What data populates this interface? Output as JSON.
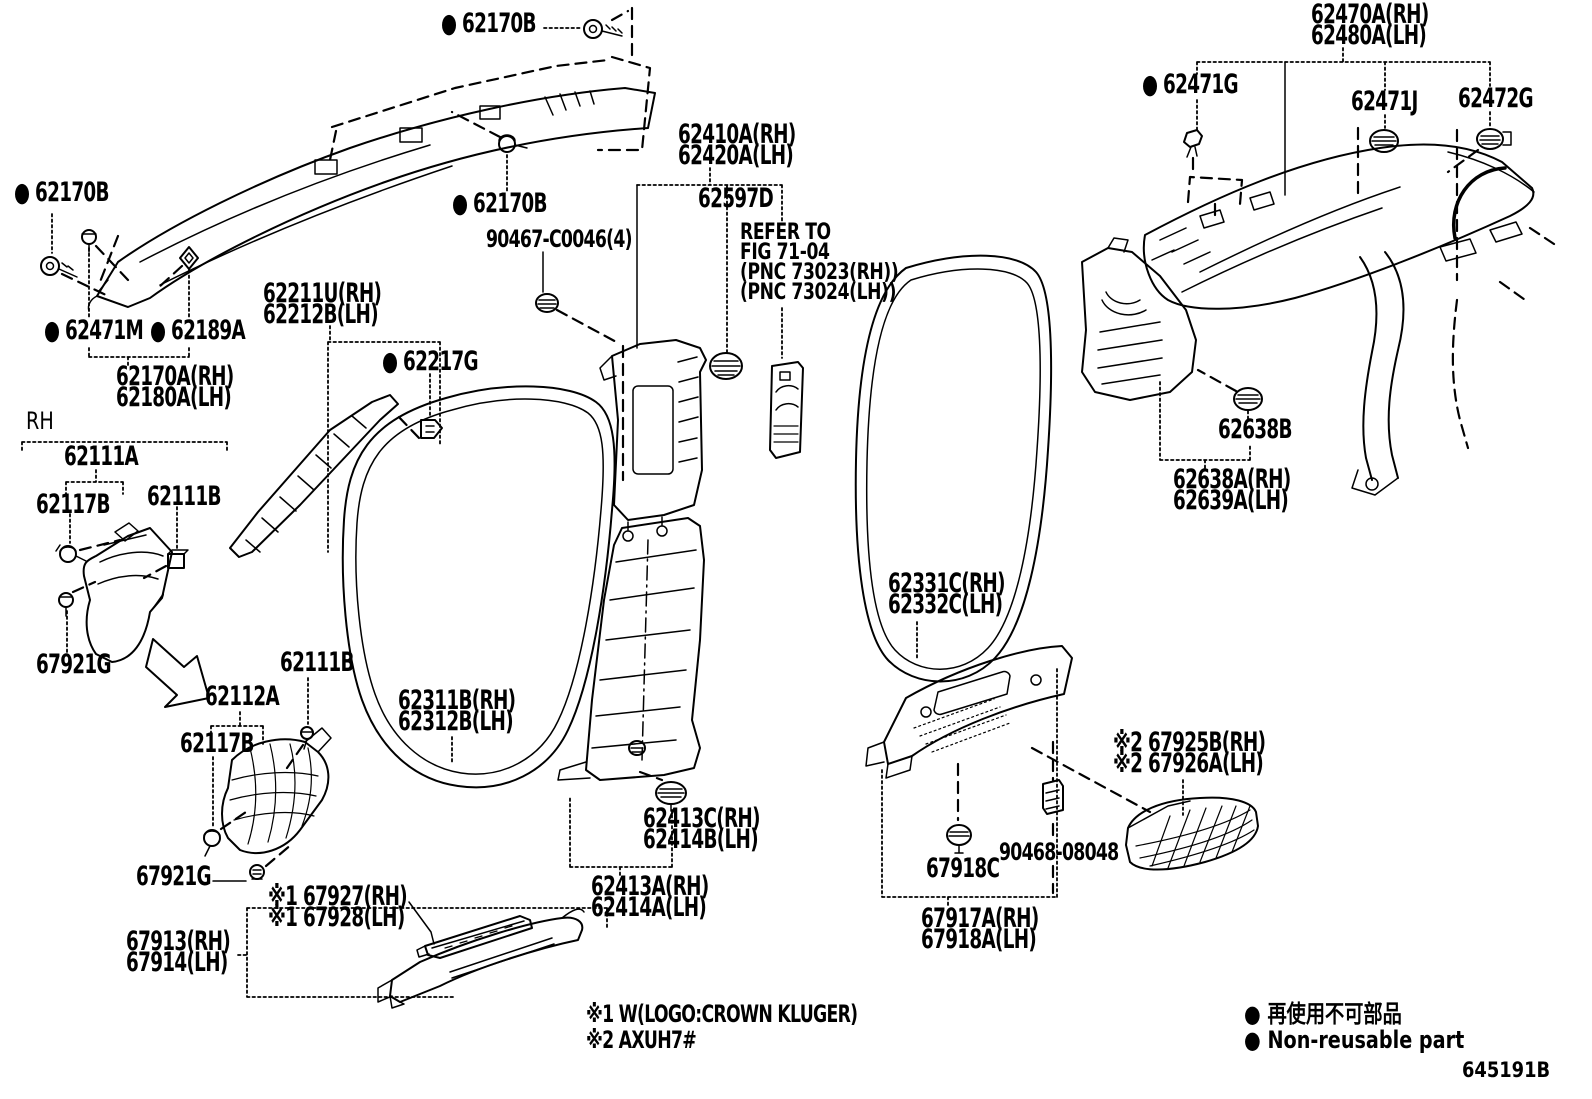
{
  "figure": {
    "code": "645191B"
  },
  "legend": {
    "jp": "● 再使用不可部品",
    "en": "● Non-reusable part"
  },
  "notes": {
    "note1": "※1 W(LOGO:CROWN KLUGER)",
    "note2": "※2 AXUH7#"
  },
  "section_marker": {
    "rh": "RH"
  },
  "labels": {
    "l62170b_top": {
      "text": "● 62170B"
    },
    "l62170b_left": {
      "text": "● 62170B"
    },
    "l62170b_mid": {
      "text": "● 62170B"
    },
    "l62471m": {
      "text": "● 62471M"
    },
    "l62189a": {
      "text": "● 62189A"
    },
    "l62170a": {
      "text": "62170A(RH)\n62180A(LH)"
    },
    "l62111a": {
      "text": "62111A"
    },
    "l62117b_1": {
      "text": "62117B"
    },
    "l62111b_1": {
      "text": "62111B"
    },
    "l67921g_1": {
      "text": "67921G"
    },
    "l62211u": {
      "text": "62211U(RH)\n62212B(LH)"
    },
    "l62217g": {
      "text": "● 62217G"
    },
    "l62112a": {
      "text": "62112A"
    },
    "l62117b_2": {
      "text": "62117B"
    },
    "l62111b_2": {
      "text": "62111B"
    },
    "l62311b": {
      "text": "62311B(RH)\n62312B(LH)"
    },
    "l67921g_2": {
      "text": "67921G"
    },
    "l67927": {
      "text": "※1 67927(RH)\n※1 67928(LH)"
    },
    "l67913": {
      "text": "67913(RH)\n67914(LH)"
    },
    "l62410a": {
      "text": "62410A(RH)\n62420A(LH)"
    },
    "l62597d": {
      "text": "62597D"
    },
    "lrefer": {
      "text": "REFER TO\nFIG 71-04\n(PNC 73023(RH))\n(PNC 73024(LH))"
    },
    "l90467": {
      "text": "90467-C0046(4)"
    },
    "l62413c": {
      "text": "62413C(RH)\n62414B(LH)"
    },
    "l62413a": {
      "text": "62413A(RH)\n62414A(LH)"
    },
    "l62331c": {
      "text": "62331C(RH)\n62332C(LH)"
    },
    "l62638b": {
      "text": "62638B"
    },
    "l62638a": {
      "text": "62638A(RH)\n62639A(LH)"
    },
    "l62470a": {
      "text": "62470A(RH)\n62480A(LH)"
    },
    "l62471g": {
      "text": "● 62471G"
    },
    "l62471j": {
      "text": "62471J"
    },
    "l62472g": {
      "text": "62472G"
    },
    "l67918c": {
      "text": "67918C"
    },
    "l90468": {
      "text": "90468-08048"
    },
    "l67917a": {
      "text": "67917A(RH)\n67918A(LH)"
    },
    "l67925b": {
      "text": "※2 67925B(RH)\n※2 67926A(LH)"
    }
  }
}
